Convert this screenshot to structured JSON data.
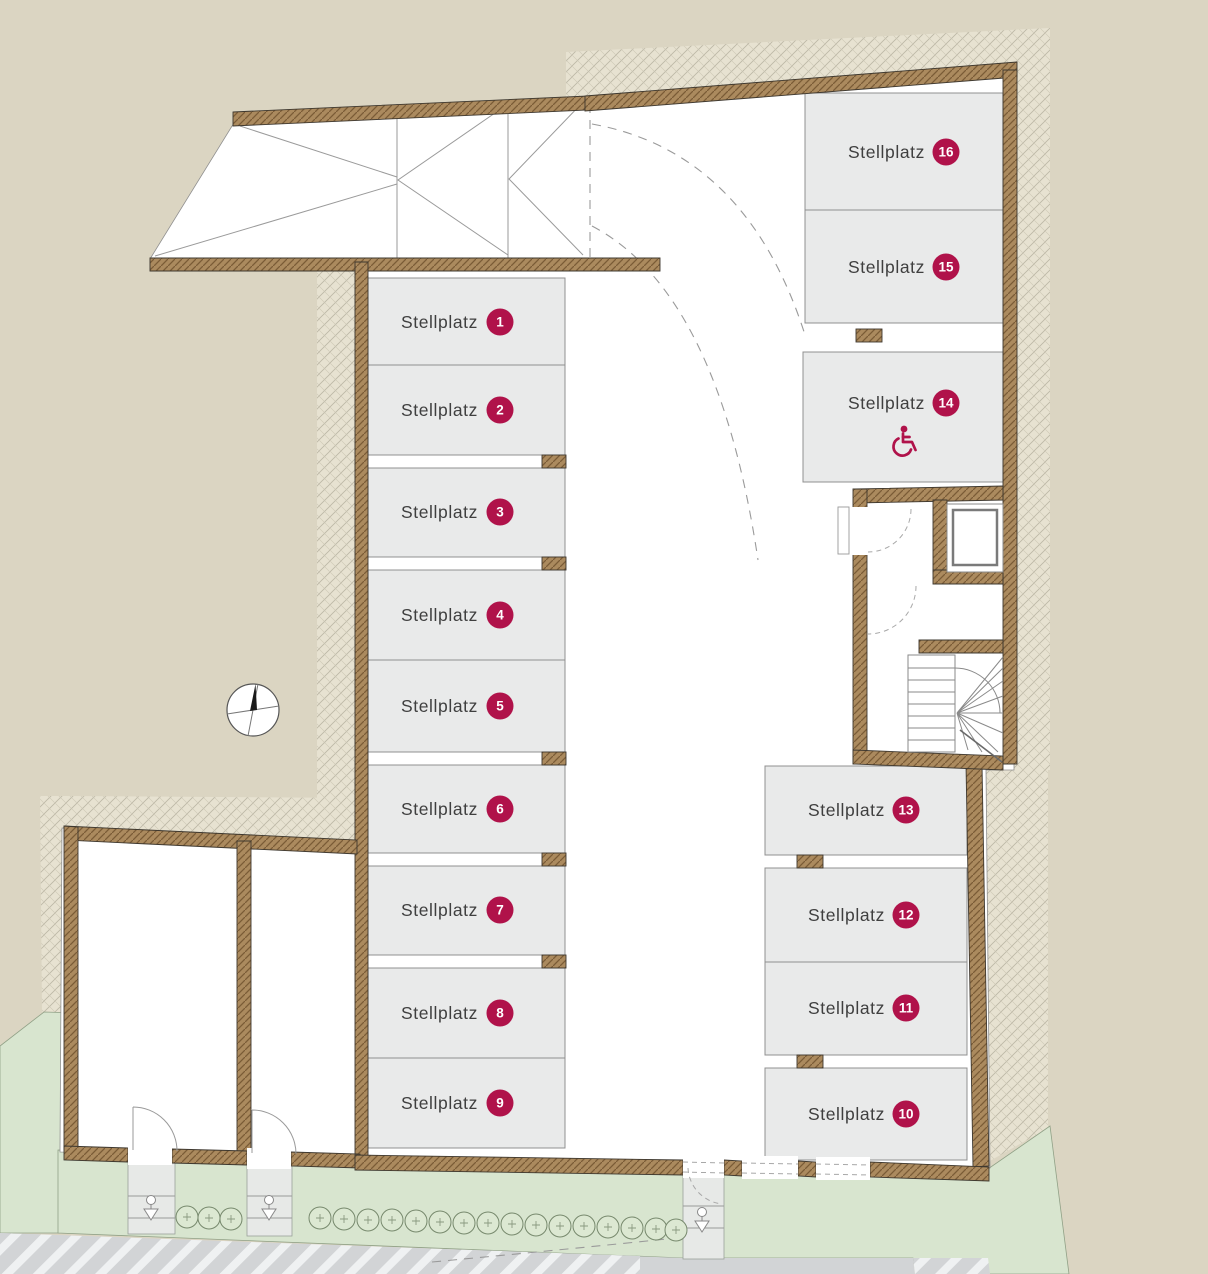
{
  "plan": {
    "type": "parking-garage-floor-plan",
    "space_label": "Stellplatz",
    "accessible_space_number": "14",
    "colors": {
      "accent": "#b0124a",
      "wall_brown": "#ab8a5e",
      "parking_gray": "#e9eaea",
      "ground_beige": "#dbd5c2",
      "lawn_green": "#d8e5cf",
      "road_gray": "#d2d4d6"
    },
    "icons": {
      "accessibility": "wheelchair-icon",
      "orientation": "compass-icon",
      "site_furniture": "lamp-marker-icon"
    },
    "spaces": [
      {
        "label": "Stellplatz",
        "number": "1"
      },
      {
        "label": "Stellplatz",
        "number": "2"
      },
      {
        "label": "Stellplatz",
        "number": "3"
      },
      {
        "label": "Stellplatz",
        "number": "4"
      },
      {
        "label": "Stellplatz",
        "number": "5"
      },
      {
        "label": "Stellplatz",
        "number": "6"
      },
      {
        "label": "Stellplatz",
        "number": "7"
      },
      {
        "label": "Stellplatz",
        "number": "8"
      },
      {
        "label": "Stellplatz",
        "number": "9"
      },
      {
        "label": "Stellplatz",
        "number": "10"
      },
      {
        "label": "Stellplatz",
        "number": "11"
      },
      {
        "label": "Stellplatz",
        "number": "12"
      },
      {
        "label": "Stellplatz",
        "number": "13"
      },
      {
        "label": "Stellplatz",
        "number": "14",
        "accessible": true
      },
      {
        "label": "Stellplatz",
        "number": "15"
      },
      {
        "label": "Stellplatz",
        "number": "16"
      }
    ]
  }
}
